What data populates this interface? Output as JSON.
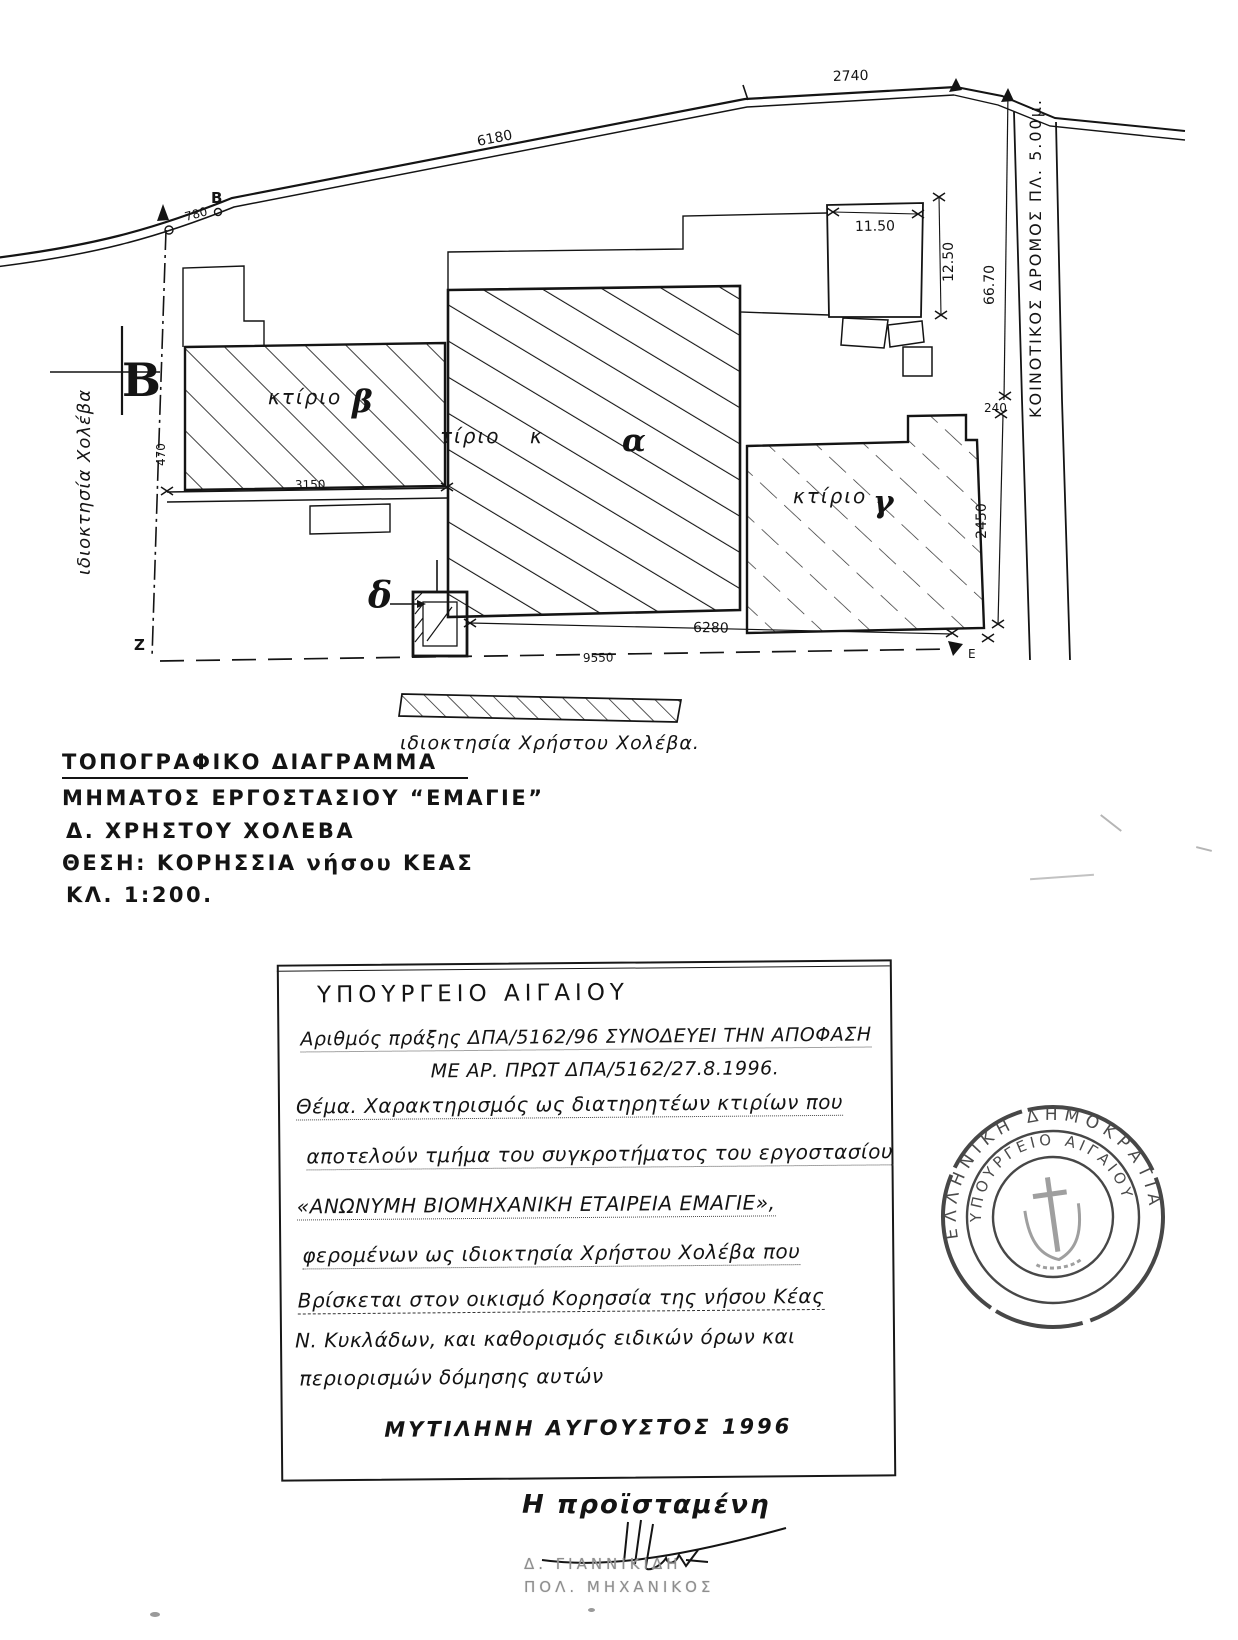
{
  "plan": {
    "points": {
      "a_label": "",
      "b": "B",
      "z": "Ζ",
      "e": "Ε",
      "section_b": "Β"
    },
    "dims": {
      "road_780": "780",
      "road_6180": "6180",
      "road_2740": "2740",
      "right_6670": "66.70",
      "bldg_1150": "11.50",
      "bldg_1250": "12.50",
      "right_240": "240",
      "right_2450": "2450",
      "beta_3150": "3150",
      "left_470": "470",
      "bottom_6280": "6280",
      "bottom_9550": "9550"
    },
    "labels": {
      "road_name": "ΚΟΙΝΟΤΙΚΟΣ ΔΡΟΜΟΣ ΠΛ. 5.00μ.",
      "building_word": "κτίριο",
      "beta": "β",
      "alpha": "α",
      "gamma": "γ",
      "delta": "δ",
      "owner_left": "ιδιοκτησία Χολέβα",
      "owner_bottom": "ιδιοκτησία Χρήστου Χολέβα."
    }
  },
  "title_block": {
    "line1": "ΤΟΠΟΓΡΑΦΙΚΟ ΔΙΑΓΡΑΜΜΑ",
    "line2": "ΜΗΜΑΤΟΣ ΕΡΓΟΣΤΑΣΙΟΥ “ΕΜΑΓΙΕ”",
    "line3": "Δ. ΧΡΗΣΤΟΥ ΧΟΛΕΒΑ",
    "line4": "ΘΕΣΗ: ΚΟΡΗΣΣΙΑ νήσου ΚΕΑΣ",
    "line5": "ΚΛ. 1:200."
  },
  "decision_box": {
    "heading": "ΥΠΟΥΡΓΕΙΟ ΑΙΓΑΙΟΥ",
    "line2": "Αριθμός πράξης ΔΠΑ/5162/96 ΣΥΝΟΔΕΥΕΙ ΤΗΝ ΑΠΟΦΑΣΗ",
    "line3": "ΜΕ ΑΡ. ΠΡΩΤ ΔΠΑ/5162/27.8.1996.",
    "line4": "Θέμα. Χαρακτηρισμός ως διατηρητέων κτιρίων που",
    "line5": "αποτελούν τμήμα του συγκροτήματος του εργοστασίου",
    "line6": "«ΑΝΩΝΥΜΗ ΒΙΟΜΗΧΑΝΙΚΗ ΕΤΑΙΡΕΙΑ ΕΜΑΓΙΕ»,",
    "line7": "φερομένων ως ιδιοκτησία Χρήστου Χολέβα που",
    "line8": "Βρίσκεται στον οικισμό Κορησσία της νήσου Κέας",
    "line9": "Ν. Κυκλάδων, και καθορισμός ειδικών όρων και",
    "line10": "περιορισμών δόμησης αυτών",
    "line11": "ΜΥΤΙΛΗΝΗ  ΑΥΓΟΥΣΤΟΣ 1996"
  },
  "stamp": {
    "outer_text": "ΕΛΛΗΝΙΚΗ ΔΗΜΟΚΡΑΤΙΑ",
    "inner_text": "ΥΠΟΥΡΓΕΙΟ ΑΙΓΑΙΟΥ"
  },
  "signature": {
    "title": "Η προϊσταμένη",
    "name": "Δ. ΓΙΑΝΝΙΚΙΔΗ",
    "role": "ΠΟΛ. ΜΗΧΑΝΙΚΟΣ"
  }
}
